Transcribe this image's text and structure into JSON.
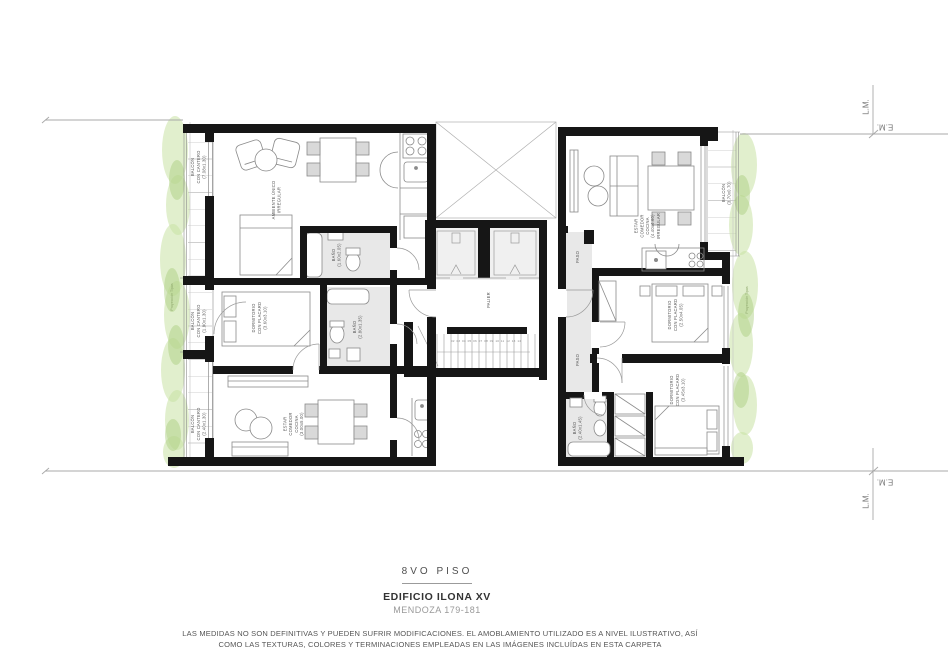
{
  "plan": {
    "left_unit": {
      "balcony_top": "BALCÓN\nCON CANTERO\n(7.08x1.30)",
      "balcony_mid": "BALCÓN\nCON CANTERO\n(1.90x1.30)",
      "balcony_bottom": "BALCÓN\nCON CANTERO\n(2.40x1.30)",
      "living": "AMBIENTE ÚNICO\nIRREGULAR",
      "bath_top": "BAÑO\n(1.60x2.05)",
      "bath_mid": "BAÑO\n(2.80x1.35)",
      "bedroom": "DORMITORIO\nCON PLACARD\n(3.60x3.10)",
      "estar": "ESTAR\nCOMEDOR\nCOCINA\n(3.00x5.00)"
    },
    "core": {
      "palier": "PALIER",
      "stair_numbers": "02 03 04 05 06 07 08 09 10 11 12 13 14"
    },
    "right_unit": {
      "paso_top": "PASO",
      "paso_mid": "PASO",
      "estar": "ESTAR\nCOMEDOR\nCOCINA\n(4.40x4.60)\nIRREGULAR",
      "balcony": "BALCÓN\n(3.70x0.70)",
      "bedroom_top": "DORMITORIO\nCON PLACARD\n(2.50x4.05)",
      "bedroom_bottom": "DORMITORIO\nCON PLACARD\n(3.45x3.10)",
      "bath": "BAÑO\n(2.40x1.45)"
    },
    "site": {
      "trees_left": "Proyección Tipas",
      "trees_right": "Proyección Tipas",
      "lm_top": "L.M.",
      "em_top": "E.M.",
      "em_bottom": "E.M.",
      "lm_bottom": "L.M."
    }
  },
  "titleblock": {
    "floor": "8VO PISO",
    "building": "EDIFICIO ILONA XV",
    "address": "MENDOZA 179-181",
    "disclaimer": "LAS MEDIDAS NO SON DEFINITIVAS Y PUEDEN SUFRIR MODIFICACIONES. EL AMOBLAMIENTO UTILIZADO ES A NIVEL ILUSTRATIVO, ASÍ\nCOMO LAS TEXTURAS, COLORES Y TERMINACIONES EMPLEADAS EN LAS IMÁGENES INCLUÍDAS EN ESTA CARPETA"
  },
  "colors": {
    "wall": "#161616",
    "thin_line": "#9e9e9e",
    "floor_gray": "#e8e8e8",
    "vegetation_green": "#c9e2a4",
    "vegetation_accent": "#a9cd7d",
    "label_text": "#555555"
  }
}
